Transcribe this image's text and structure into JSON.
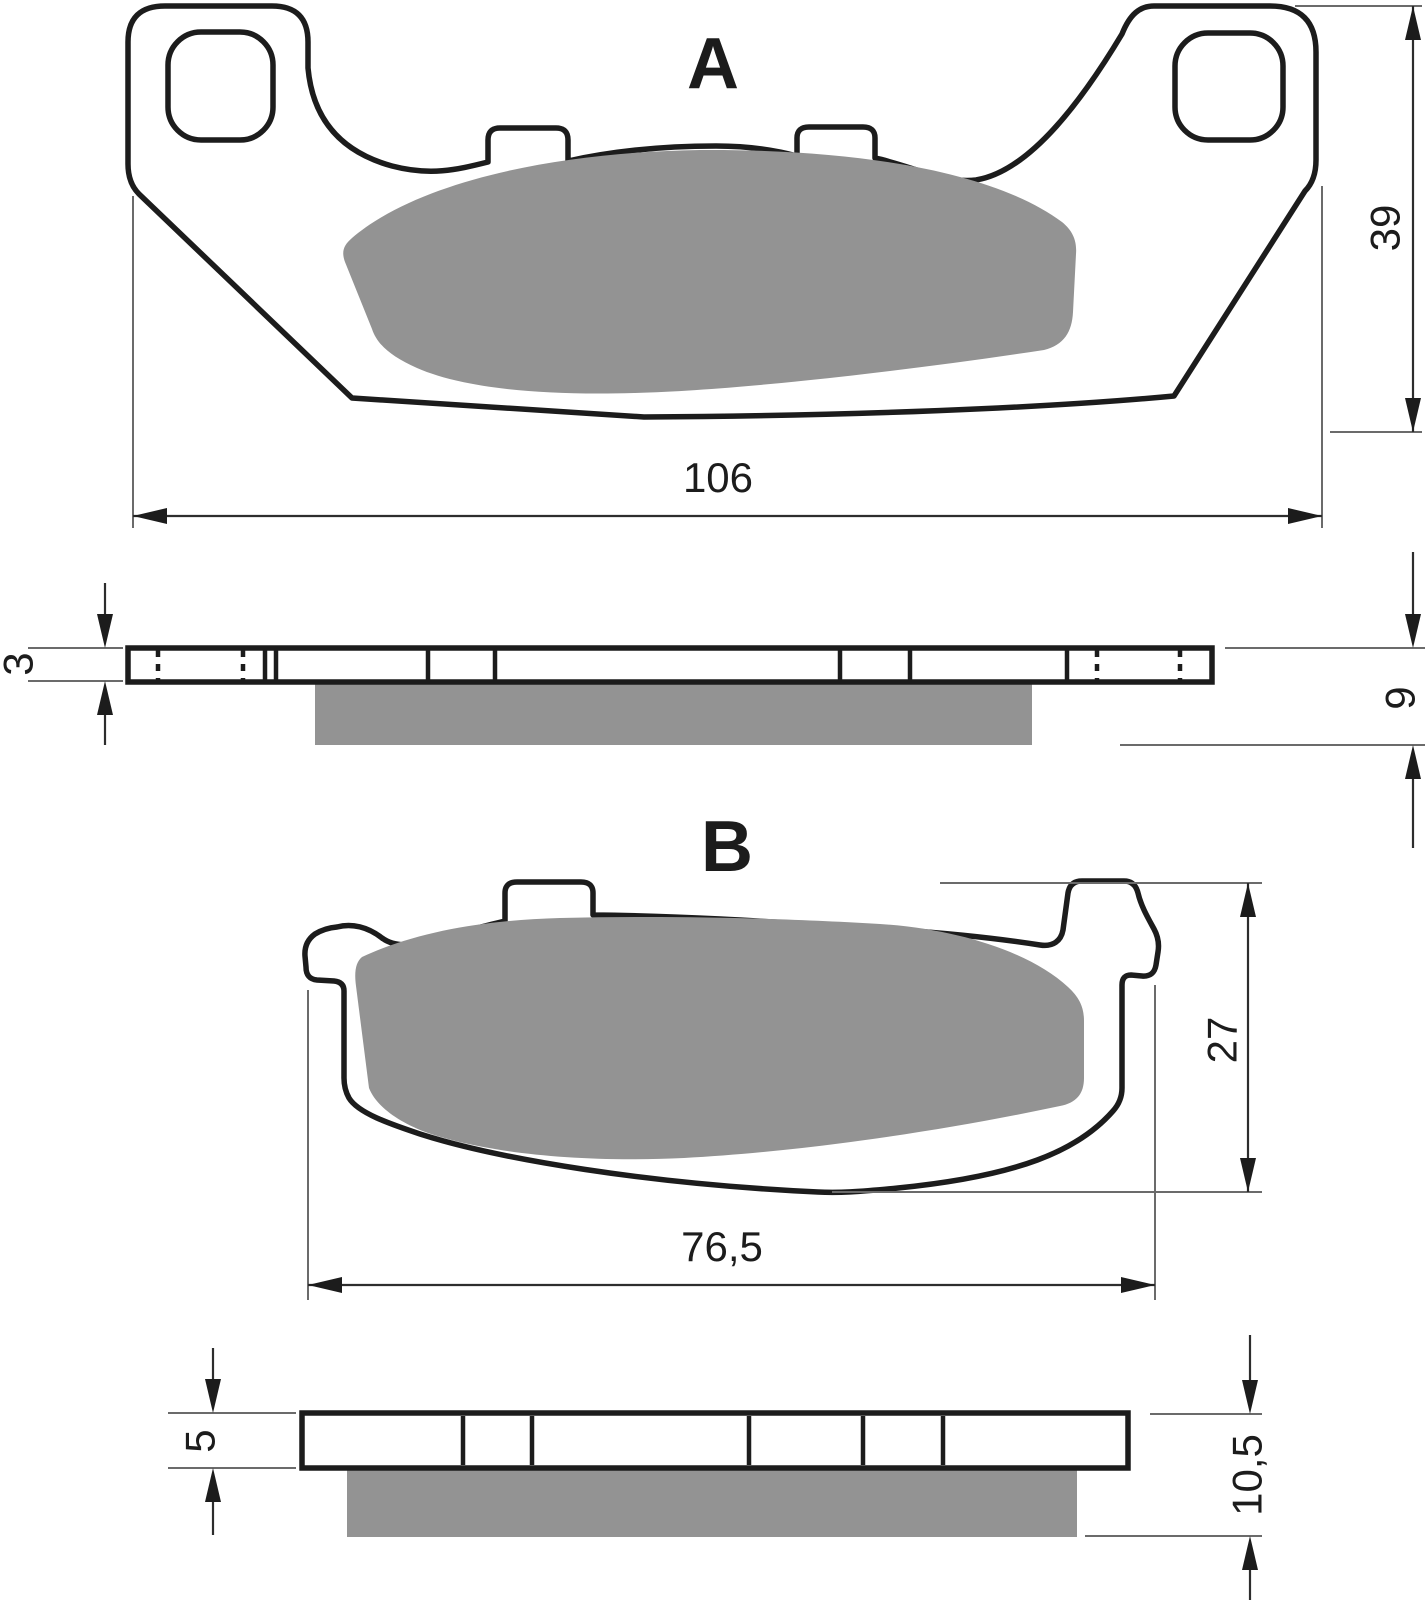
{
  "diagram": {
    "colors": {
      "background": "#ffffff",
      "outline": "#1c1c1c",
      "friction": "#939393",
      "thin_line": "#6b6b6b",
      "text": "#1c1c1c"
    },
    "pad_a": {
      "label": "A",
      "front": {
        "width": "106",
        "height": "39"
      },
      "side": {
        "plate_thickness": "3",
        "total_thickness": "9"
      }
    },
    "pad_b": {
      "label": "B",
      "front": {
        "width": "76,5",
        "height": "27"
      },
      "side": {
        "plate_thickness": "5",
        "total_thickness": "10,5"
      }
    }
  }
}
